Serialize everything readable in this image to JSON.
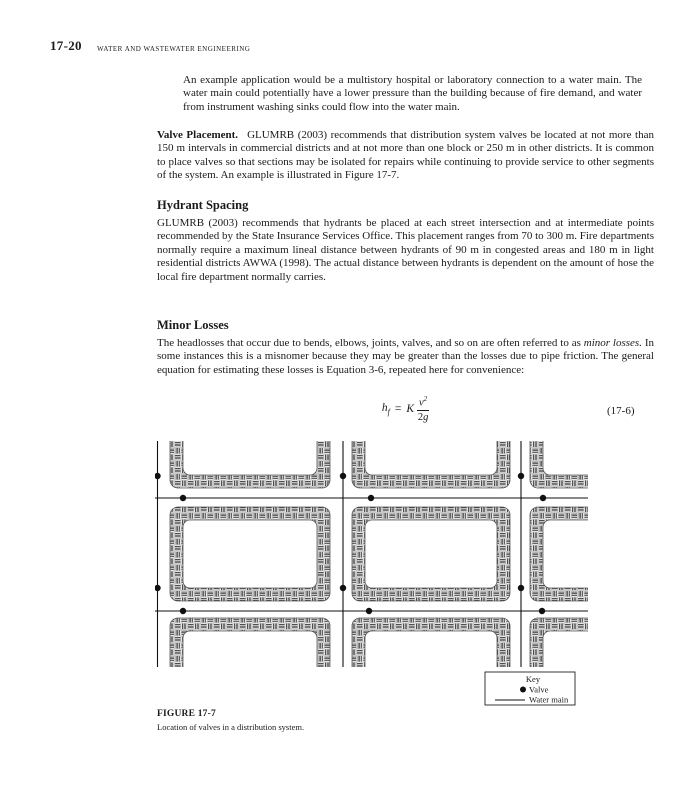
{
  "page": {
    "number": "17-20",
    "running_head": "WATER AND WASTEWATER ENGINEERING"
  },
  "intro_paragraph": "An example application would be a multistory hospital or laboratory connection to a water main. The water main could potentially have a lower pressure than the building because of fire demand, and water from instrument washing sinks could flow into the water main.",
  "valve_placement": {
    "run_in_heading": "Valve Placement.",
    "body": "GLUMRB (2003) recommends that distribution system valves be located at not more than 150 m intervals in commercial districts and at not more than one block or 250 m in other districts. It is common to place valves so that sections may be isolated for repairs while continuing to provide service to other segments of the system. An example is illustrated in Figure 17-7."
  },
  "hydrant_spacing": {
    "heading": "Hydrant Spacing",
    "body": "GLUMRB (2003) recommends that hydrants be placed at each street intersection and at intermediate points recommended by the State Insurance Services Office. This placement ranges from 70 to 300 m. Fire departments normally require a maximum lineal distance between hydrants of 90 m in congested areas and 180 m in light residential districts AWWA (1998). The actual distance between hydrants is dependent on the amount of hose the local fire department normally carries."
  },
  "minor_losses": {
    "heading": "Minor Losses",
    "body_lead": "The headlosses that occur due to bends, elbows, joints, valves, and so on are often referred to as ",
    "body_italic": "minor losses.",
    "body_rest": " In some instances this is a misnomer because they may be greater than the losses due to pipe friction. The general equation for estimating these losses is Equation 3-6, repeated here for convenience:"
  },
  "equation": {
    "lhs_base": "h",
    "lhs_sub": "f",
    "equals": "=",
    "coefficient": "K",
    "numerator_base": "v",
    "numerator_exp": "2",
    "den_coef": "2",
    "den_var": "g",
    "tag": "(17-6)"
  },
  "figure": {
    "key": {
      "title": "Key",
      "valve_label": "Valve",
      "main_label": "Water main"
    },
    "caption_label": "FIGURE 17-7",
    "caption_text": "Location of valves in a distribution system.",
    "water_mains": {
      "vertical_x": [
        2.5,
        188,
        366
      ],
      "horizontal_y": [
        57,
        170
      ],
      "x_extent": [
        0,
        433
      ],
      "y_extent": [
        0,
        226
      ]
    },
    "valve_radius": 3.2,
    "valves": [
      {
        "x": 2.5,
        "y": 35
      },
      {
        "x": 2.5,
        "y": 147
      },
      {
        "x": 188,
        "y": 35
      },
      {
        "x": 188,
        "y": 147
      },
      {
        "x": 366,
        "y": 35
      },
      {
        "x": 366,
        "y": 147
      },
      {
        "x": 28,
        "y": 57
      },
      {
        "x": 216,
        "y": 57
      },
      {
        "x": 388,
        "y": 57
      },
      {
        "x": 28,
        "y": 170
      },
      {
        "x": 214,
        "y": 170
      },
      {
        "x": 387,
        "y": 170
      }
    ]
  }
}
